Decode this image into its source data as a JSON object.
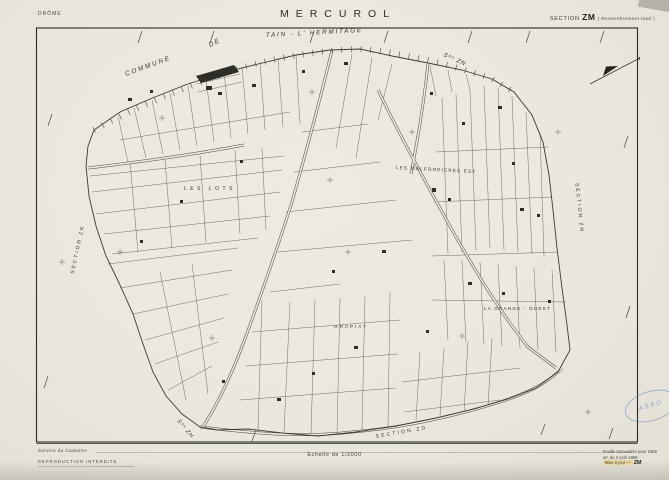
{
  "header": {
    "department": "DRÔME",
    "title": "MERCUROL",
    "section_label": "SECTION",
    "section_code": "ZM",
    "section_note": "( Remembrement total )"
  },
  "footer": {
    "issuer": "Service du Cadastre",
    "notice": "REPRODUCTION INTERDITE",
    "scale": "Echelle de 1/2000",
    "revision_line1": "Feuille renouvelée pour 1969",
    "revision_line2": "arr. du 2 avril 1969",
    "revision_line3": "Mise à jour —",
    "revision_code": "ZM"
  },
  "map": {
    "labels": {
      "commune": "COMMUNE",
      "de": "DE",
      "neighbor_commune": "TAIN - L' HERMITAGE",
      "section_zn_small": "Sᵒⁿ ZN",
      "les_lots": "LES LOTS",
      "malfondieres": "LES MALFONDIERES EST",
      "grange_ouest": "LA GRANGE - OUEST",
      "grapiat": "GRAPIAT",
      "section_zk": "SECTION ZK",
      "section_zn": "SECTION ZN",
      "section_zh_small": "Sᵒⁿ ZH",
      "section_zd": "SECTION  ZD"
    }
  },
  "stamp": {
    "text": "ASSO"
  },
  "colors": {
    "paper": "#eae7df",
    "ink": "#3a392f",
    "highlight": "#e7d79a",
    "stamp_blue": "#4a6eb4"
  }
}
